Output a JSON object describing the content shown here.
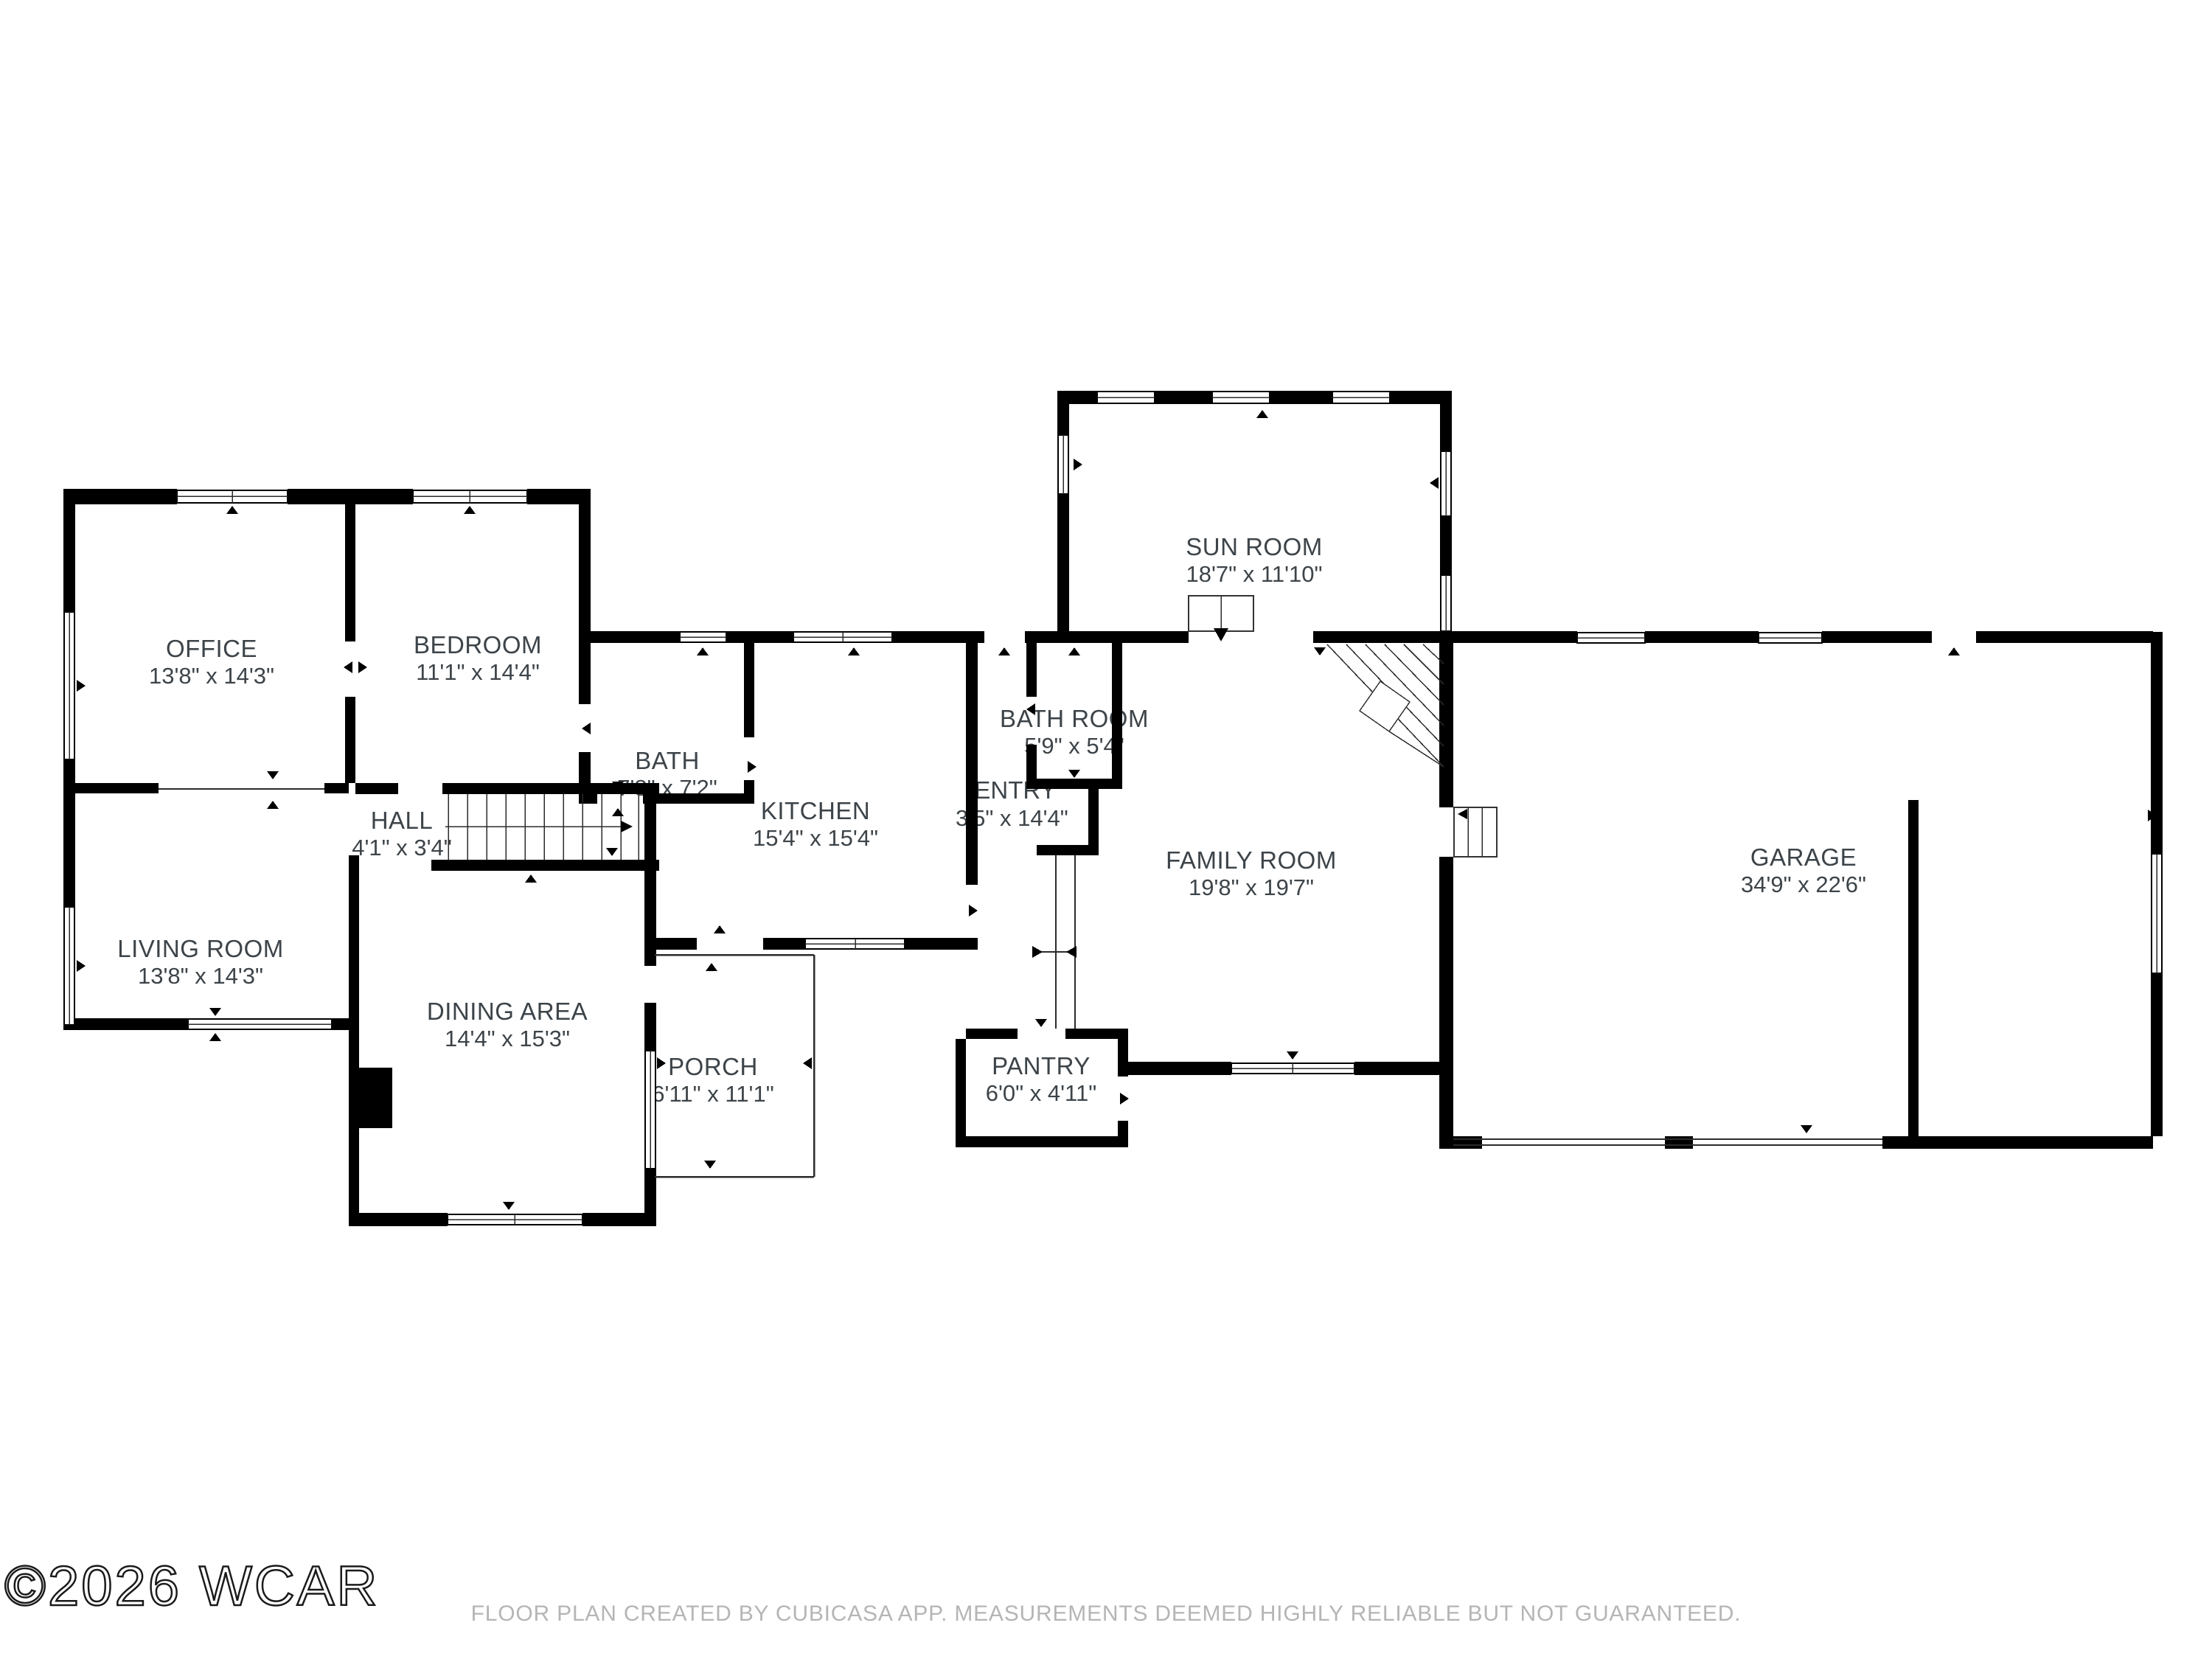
{
  "watermark": "©2026 WCAR",
  "footer": "FLOOR PLAN CREATED BY CUBICASA APP. MEASUREMENTS DEEMED HIGHLY RELIABLE BUT NOT GUARANTEED.",
  "colors": {
    "wall": "#000000",
    "label": "#3d4449",
    "footer": "#b5b5b5",
    "background": "#ffffff"
  },
  "rooms": [
    {
      "id": "office",
      "name": "OFFICE",
      "dims": "13'8\" x 14'3\""
    },
    {
      "id": "bedroom",
      "name": "BEDROOM",
      "dims": "11'1\" x 14'4\""
    },
    {
      "id": "bath",
      "name": "BATH",
      "dims": "7'8\" x 7'2\""
    },
    {
      "id": "hall",
      "name": "HALL",
      "dims": "4'1\" x 3'4\""
    },
    {
      "id": "living-room",
      "name": "LIVING ROOM",
      "dims": "13'8\" x 14'3\""
    },
    {
      "id": "dining-area",
      "name": "DINING AREA",
      "dims": "14'4\" x 15'3\""
    },
    {
      "id": "porch",
      "name": "PORCH",
      "dims": "6'11\" x 11'1\""
    },
    {
      "id": "kitchen",
      "name": "KITCHEN",
      "dims": "15'4\" x 15'4\""
    },
    {
      "id": "entry",
      "name": "ENTRY",
      "dims": "3'5\" x 14'4\""
    },
    {
      "id": "bath-room",
      "name": "BATH ROOM",
      "dims": "5'9\" x 5'4\""
    },
    {
      "id": "pantry",
      "name": "PANTRY",
      "dims": "6'0\" x 4'11\""
    },
    {
      "id": "sun-room",
      "name": "SUN ROOM",
      "dims": "18'7\" x 11'10\""
    },
    {
      "id": "family-room",
      "name": "FAMILY ROOM",
      "dims": "19'8\" x 19'7\""
    },
    {
      "id": "garage",
      "name": "GARAGE",
      "dims": "34'9\" x 22'6\""
    }
  ]
}
